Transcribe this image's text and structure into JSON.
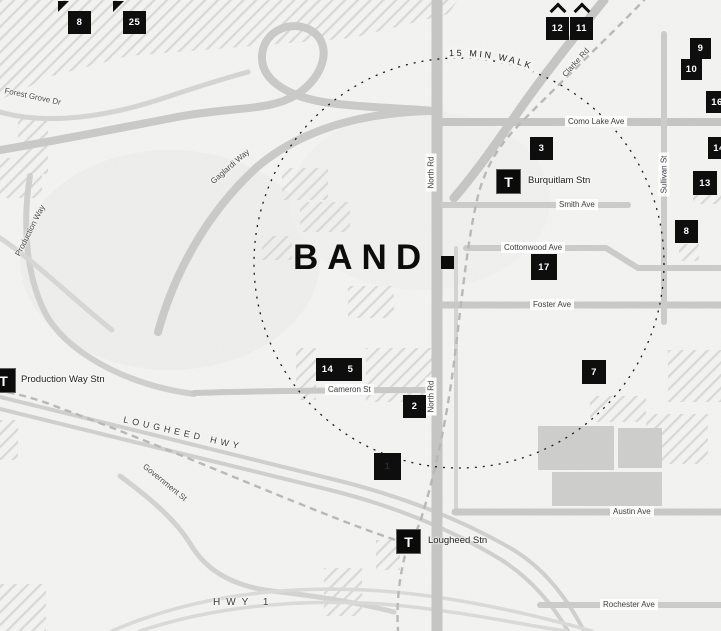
{
  "title": {
    "text": "BAND"
  },
  "ring": {
    "label": "15 MIN WALK"
  },
  "station_icon": "T",
  "stations": [
    {
      "label": "Burquitlam Stn"
    },
    {
      "label": "Production Way Stn"
    },
    {
      "label": "Lougheed Stn"
    }
  ],
  "markers": [
    {
      "n": "8"
    },
    {
      "n": "25"
    },
    {
      "n": "12"
    },
    {
      "n": "11"
    },
    {
      "n": "9"
    },
    {
      "n": "10"
    },
    {
      "n": "16"
    },
    {
      "n": "14"
    },
    {
      "n": "13"
    },
    {
      "n": "8"
    },
    {
      "n": "3"
    },
    {
      "n": "17"
    },
    {
      "n": "7"
    },
    {
      "n": "14"
    },
    {
      "n": "5"
    },
    {
      "n": "2"
    },
    {
      "n": "1"
    }
  ],
  "streets": {
    "forest_grove_dr": "Forest Grove Dr",
    "gaglardi_way": "Gaglardi Way",
    "production_way": "Production Way",
    "lougheed_hwy": "LOUGHEED HWY",
    "government_st": "Government St",
    "hwy1": "HWY 1",
    "cameron_st": "Cameron St",
    "north_rd_upper": "North Rd",
    "north_rd_lower": "North Rd",
    "clarke_rd": "Clarke Rd",
    "como_lake_ave": "Como Lake Ave",
    "sullivan_st": "Sullivan St",
    "smith_ave": "Smith Ave",
    "cottonwood_ave": "Cottonwood Ave",
    "foster_ave": "Foster Ave",
    "austin_ave": "Austin Ave",
    "rochester_ave": "Rochester Ave"
  },
  "colors": {
    "background": "#f4f4f2",
    "road": "#c7c7c6",
    "road_light": "#d6d6d5",
    "hatch": "#d8d8d7",
    "block": "#cdcdcc",
    "marker_bg": "#0e0e0e",
    "marker_text": "#ffffff",
    "ring_stroke": "#1a1a1a"
  }
}
